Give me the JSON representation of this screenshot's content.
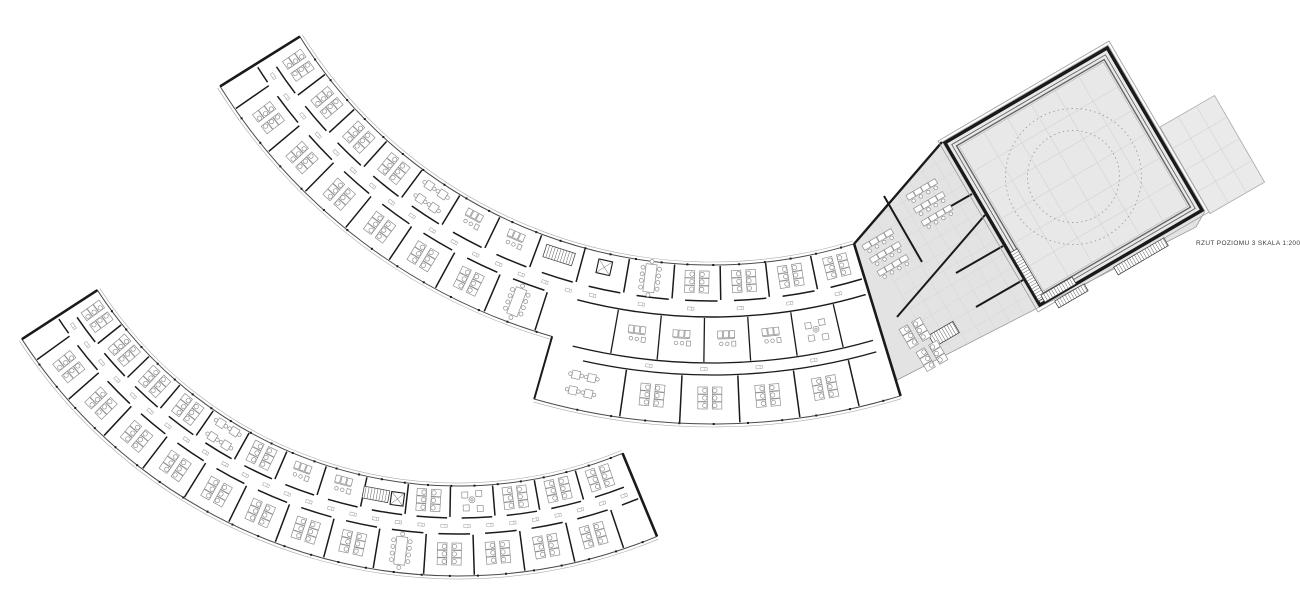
{
  "caption": {
    "text": "RZUT POZIOMU 3 SKALA 1:200",
    "level": "3",
    "scale": "1:200"
  },
  "colors": {
    "background": "#ffffff",
    "wall": "#1a1a1a",
    "facade": "#4a4a4a",
    "faint": "#ababab",
    "furniture": "#8f8f8f",
    "zone_fill": "#e3e3e3",
    "hall_fill": "#e8e8e8",
    "terrace_fill": "#eaeaea",
    "grid": "#d3d3d3",
    "dotted_circle": "#9a9a9a",
    "caption_text": "#3a3a3a"
  }
}
